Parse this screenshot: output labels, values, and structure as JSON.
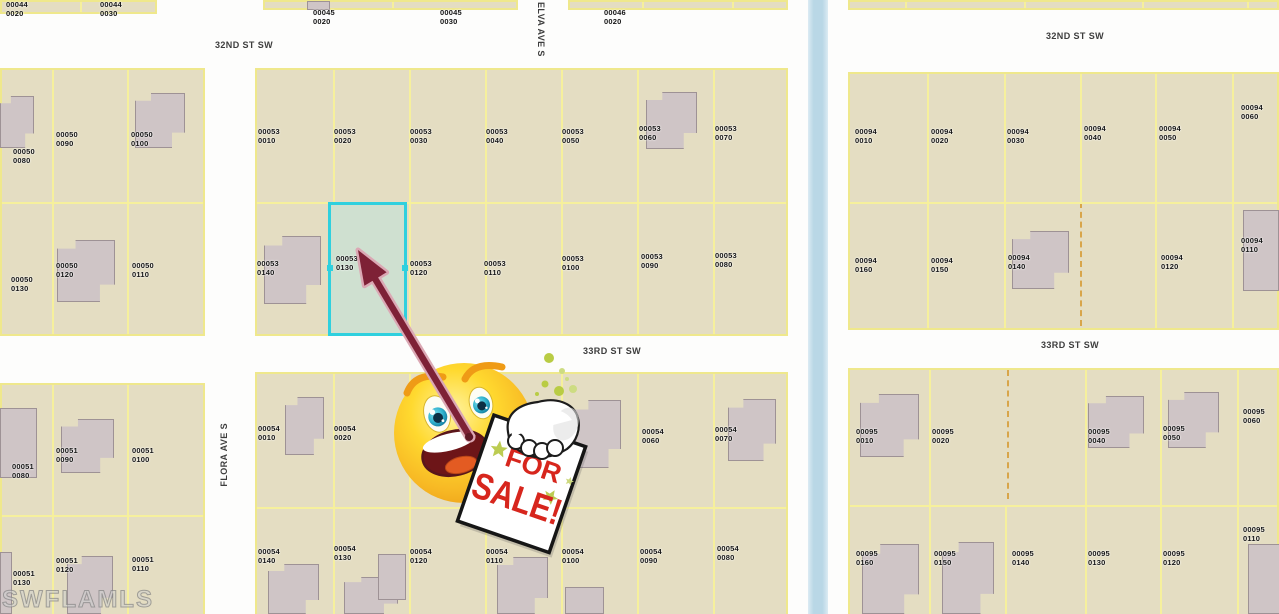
{
  "map": {
    "watermark": "SWFLAMLS",
    "colors": {
      "parcel_fill": "#e4ddc2",
      "lot_line": "#f6f09c",
      "building_fill": "#cfc5c6",
      "canal_blue": "#b9d7e6",
      "highlight_border": "#2fd0de",
      "highlight_fill": "#cfe0d0",
      "street_text": "#3d3d3d",
      "dashed_line": "#d8a54a"
    },
    "highlight": {
      "parcel": "00053 0130"
    },
    "streets": [
      {
        "label": "32ND ST SW",
        "x": 215,
        "y": 40,
        "dir": "h"
      },
      {
        "label": "32ND ST SW",
        "x": 1046,
        "y": 31,
        "dir": "h"
      },
      {
        "label": "33RD ST SW",
        "x": 583,
        "y": 346,
        "dir": "h"
      },
      {
        "label": "33RD ST SW",
        "x": 1041,
        "y": 340,
        "dir": "h"
      },
      {
        "label": "ELVA AVE S",
        "x": 536,
        "y": 2,
        "dir": "v-down"
      },
      {
        "label": "FLORA AVE S",
        "x": 219,
        "y": 423,
        "dir": "v-up"
      }
    ],
    "parcels": [
      {
        "block": "00044",
        "lot": "0020",
        "x": 6,
        "y": 1
      },
      {
        "block": "00044",
        "lot": "0030",
        "x": 100,
        "y": 1
      },
      {
        "block": "00045",
        "lot": "0020",
        "x": 313,
        "y": 9
      },
      {
        "block": "00045",
        "lot": "0030",
        "x": 440,
        "y": 9
      },
      {
        "block": "00046",
        "lot": "0020",
        "x": 604,
        "y": 9
      },
      {
        "block": "00050",
        "lot": "0080",
        "x": 13,
        "y": 148
      },
      {
        "block": "00050",
        "lot": "0090",
        "x": 56,
        "y": 131
      },
      {
        "block": "00050",
        "lot": "0100",
        "x": 131,
        "y": 131
      },
      {
        "block": "00050",
        "lot": "0130",
        "x": 11,
        "y": 276
      },
      {
        "block": "00050",
        "lot": "0120",
        "x": 56,
        "y": 262
      },
      {
        "block": "00050",
        "lot": "0110",
        "x": 132,
        "y": 262
      },
      {
        "block": "00053",
        "lot": "0010",
        "x": 258,
        "y": 128
      },
      {
        "block": "00053",
        "lot": "0020",
        "x": 334,
        "y": 128
      },
      {
        "block": "00053",
        "lot": "0030",
        "x": 410,
        "y": 128
      },
      {
        "block": "00053",
        "lot": "0040",
        "x": 486,
        "y": 128
      },
      {
        "block": "00053",
        "lot": "0050",
        "x": 562,
        "y": 128
      },
      {
        "block": "00053",
        "lot": "0060",
        "x": 639,
        "y": 125
      },
      {
        "block": "00053",
        "lot": "0070",
        "x": 715,
        "y": 125
      },
      {
        "block": "00053",
        "lot": "0140",
        "x": 257,
        "y": 260
      },
      {
        "block": "00053",
        "lot": "0130",
        "x": 336,
        "y": 255
      },
      {
        "block": "00053",
        "lot": "0120",
        "x": 410,
        "y": 260
      },
      {
        "block": "00053",
        "lot": "0110",
        "x": 484,
        "y": 260
      },
      {
        "block": "00053",
        "lot": "0100",
        "x": 562,
        "y": 255
      },
      {
        "block": "00053",
        "lot": "0090",
        "x": 641,
        "y": 253
      },
      {
        "block": "00053",
        "lot": "0080",
        "x": 715,
        "y": 252
      },
      {
        "block": "00094",
        "lot": "0010",
        "x": 855,
        "y": 128
      },
      {
        "block": "00094",
        "lot": "0020",
        "x": 931,
        "y": 128
      },
      {
        "block": "00094",
        "lot": "0030",
        "x": 1007,
        "y": 128
      },
      {
        "block": "00094",
        "lot": "0040",
        "x": 1084,
        "y": 125
      },
      {
        "block": "00094",
        "lot": "0050",
        "x": 1159,
        "y": 125
      },
      {
        "block": "00094",
        "lot": "0060",
        "x": 1241,
        "y": 104
      },
      {
        "block": "00094",
        "lot": "0160",
        "x": 855,
        "y": 257
      },
      {
        "block": "00094",
        "lot": "0150",
        "x": 931,
        "y": 257
      },
      {
        "block": "00094",
        "lot": "0140",
        "x": 1008,
        "y": 254
      },
      {
        "block": "00094",
        "lot": "0120",
        "x": 1161,
        "y": 254
      },
      {
        "block": "00094",
        "lot": "0110",
        "x": 1241,
        "y": 237
      },
      {
        "block": "00051",
        "lot": "0080",
        "x": 12,
        "y": 463
      },
      {
        "block": "00051",
        "lot": "0090",
        "x": 56,
        "y": 447
      },
      {
        "block": "00051",
        "lot": "0100",
        "x": 132,
        "y": 447
      },
      {
        "block": "00051",
        "lot": "0130",
        "x": 13,
        "y": 570
      },
      {
        "block": "00051",
        "lot": "0120",
        "x": 56,
        "y": 557
      },
      {
        "block": "00051",
        "lot": "0110",
        "x": 132,
        "y": 556
      },
      {
        "block": "00054",
        "lot": "0010",
        "x": 258,
        "y": 425
      },
      {
        "block": "00054",
        "lot": "0020",
        "x": 334,
        "y": 425
      },
      {
        "block": "00054",
        "lot": "0060",
        "x": 642,
        "y": 428
      },
      {
        "block": "00054",
        "lot": "0070",
        "x": 715,
        "y": 426
      },
      {
        "block": "00054",
        "lot": "0140",
        "x": 258,
        "y": 548
      },
      {
        "block": "00054",
        "lot": "0130",
        "x": 334,
        "y": 545
      },
      {
        "block": "00054",
        "lot": "0120",
        "x": 410,
        "y": 548
      },
      {
        "block": "00054",
        "lot": "0110",
        "x": 486,
        "y": 548
      },
      {
        "block": "00054",
        "lot": "0100",
        "x": 562,
        "y": 548
      },
      {
        "block": "00054",
        "lot": "0090",
        "x": 640,
        "y": 548
      },
      {
        "block": "00054",
        "lot": "0080",
        "x": 717,
        "y": 545
      },
      {
        "block": "00095",
        "lot": "0010",
        "x": 856,
        "y": 428
      },
      {
        "block": "00095",
        "lot": "0020",
        "x": 932,
        "y": 428
      },
      {
        "block": "00095",
        "lot": "0040",
        "x": 1088,
        "y": 428
      },
      {
        "block": "00095",
        "lot": "0050",
        "x": 1163,
        "y": 425
      },
      {
        "block": "00095",
        "lot": "0060",
        "x": 1243,
        "y": 408
      },
      {
        "block": "00095",
        "lot": "0160",
        "x": 856,
        "y": 550
      },
      {
        "block": "00095",
        "lot": "0150",
        "x": 934,
        "y": 550
      },
      {
        "block": "00095",
        "lot": "0140",
        "x": 1012,
        "y": 550
      },
      {
        "block": "00095",
        "lot": "0130",
        "x": 1088,
        "y": 550
      },
      {
        "block": "00095",
        "lot": "0120",
        "x": 1163,
        "y": 550
      },
      {
        "block": "00095",
        "lot": "0110",
        "x": 1243,
        "y": 526
      }
    ]
  },
  "sticker": {
    "line1": "FOR",
    "line2": "SALE!",
    "sign_text_color": "#d7261d",
    "star_color": "#bccc52",
    "arrow_color": "#7e2136"
  }
}
